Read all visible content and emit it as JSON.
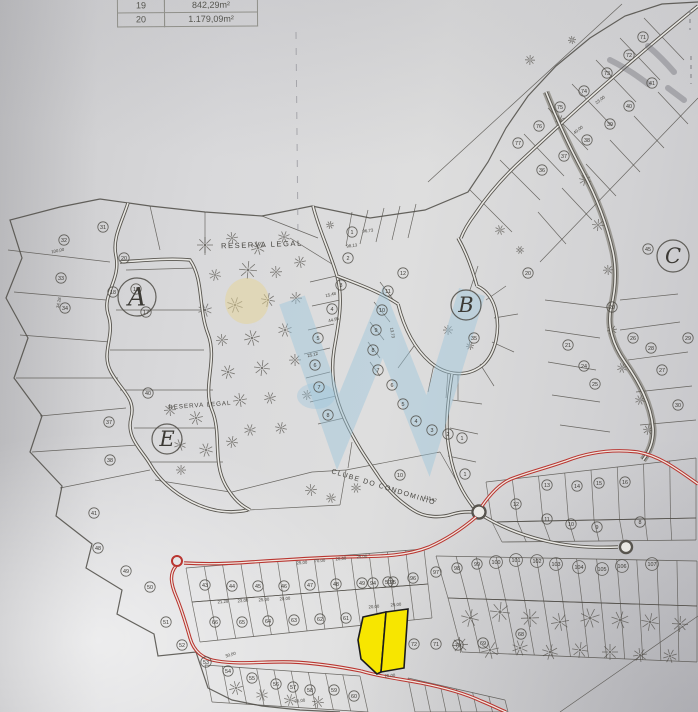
{
  "table": {
    "rows": [
      {
        "id": "19",
        "area": "842,29m²"
      },
      {
        "id": "20",
        "area": "1.179,09m²"
      }
    ]
  },
  "map": {
    "region_labels": [
      {
        "text": "RESERVA LEGAL",
        "x": 262,
        "y": 247,
        "rot": -2,
        "size": 7.5,
        "spacing": 1.6
      },
      {
        "text": "RESERVA LEGAL",
        "x": 200,
        "y": 407,
        "rot": -4,
        "size": 6.2,
        "spacing": 1
      },
      {
        "text": "CLUBE DO CONDOMINIO",
        "x": 383,
        "y": 489,
        "rot": 17,
        "size": 7,
        "spacing": 1.3
      }
    ],
    "sections": [
      {
        "letter": "A",
        "x": 137,
        "y": 297,
        "r": 19,
        "size": 25
      },
      {
        "letter": "B",
        "x": 466,
        "y": 305,
        "r": 15,
        "size": 21
      },
      {
        "letter": "C",
        "x": 673,
        "y": 256,
        "r": 16,
        "size": 21
      },
      {
        "letter": "E",
        "x": 167,
        "y": 439,
        "r": 15,
        "size": 21
      }
    ],
    "plot_numbers": [
      [
        31,
        103,
        227
      ],
      [
        32,
        64,
        240
      ],
      [
        33,
        61,
        278
      ],
      [
        34,
        65,
        308
      ],
      [
        20,
        124,
        258
      ],
      [
        19,
        136,
        289
      ],
      [
        18,
        113,
        292
      ],
      [
        17,
        146,
        312
      ],
      [
        37,
        109,
        422
      ],
      [
        40,
        148,
        393
      ],
      [
        38,
        110,
        460
      ],
      [
        41,
        94,
        513
      ],
      [
        48,
        98,
        548
      ],
      [
        49,
        126,
        571
      ],
      [
        50,
        150,
        587
      ],
      [
        51,
        166,
        622
      ],
      [
        52,
        182,
        645
      ],
      [
        3,
        341,
        285
      ],
      [
        4,
        332,
        309
      ],
      [
        5,
        318,
        338
      ],
      [
        6,
        315,
        365
      ],
      [
        7,
        319,
        387
      ],
      [
        8,
        328,
        415
      ],
      [
        1,
        352,
        232
      ],
      [
        2,
        348,
        258
      ],
      [
        12,
        403,
        273
      ],
      [
        11,
        388,
        291
      ],
      [
        10,
        382,
        310
      ],
      [
        9,
        376,
        330
      ],
      [
        8,
        373,
        350
      ],
      [
        7,
        378,
        370
      ],
      [
        6,
        392,
        385
      ],
      [
        5,
        403,
        404
      ],
      [
        4,
        416,
        421
      ],
      [
        3,
        432,
        430
      ],
      [
        2,
        448,
        434
      ],
      [
        1,
        462,
        438
      ],
      [
        20,
        528,
        273
      ],
      [
        35,
        474,
        338
      ],
      [
        71,
        643,
        37
      ],
      [
        72,
        629,
        55
      ],
      [
        73,
        607,
        73
      ],
      [
        74,
        584,
        91
      ],
      [
        75,
        560,
        107
      ],
      [
        76,
        539,
        126
      ],
      [
        77,
        518,
        143
      ],
      [
        38,
        587,
        140
      ],
      [
        37,
        564,
        156
      ],
      [
        36,
        542,
        170
      ],
      [
        39,
        610,
        124
      ],
      [
        40,
        629,
        106
      ],
      [
        41,
        652,
        83
      ],
      [
        45,
        648,
        249
      ],
      [
        20,
        612,
        307
      ],
      [
        21,
        568,
        345
      ],
      [
        24,
        584,
        366
      ],
      [
        25,
        595,
        384
      ],
      [
        26,
        633,
        338
      ],
      [
        28,
        651,
        348
      ],
      [
        27,
        662,
        370
      ],
      [
        29,
        688,
        338
      ],
      [
        30,
        678,
        405
      ],
      [
        43,
        205,
        585
      ],
      [
        44,
        232,
        586
      ],
      [
        45,
        258,
        586
      ],
      [
        46,
        284,
        586
      ],
      [
        47,
        310,
        585
      ],
      [
        48,
        336,
        584
      ],
      [
        49,
        362,
        583
      ],
      [
        50,
        388,
        582
      ],
      [
        66,
        215,
        622
      ],
      [
        65,
        242,
        622
      ],
      [
        64,
        268,
        621
      ],
      [
        63,
        294,
        620
      ],
      [
        62,
        320,
        619
      ],
      [
        61,
        346,
        618
      ],
      [
        72,
        414,
        644
      ],
      [
        71,
        436,
        644
      ],
      [
        70,
        458,
        645
      ],
      [
        69,
        483,
        643
      ],
      [
        68,
        521,
        634
      ],
      [
        94,
        373,
        583
      ],
      [
        95,
        393,
        582
      ],
      [
        96,
        413,
        578
      ],
      [
        97,
        436,
        572
      ],
      [
        98,
        457,
        568
      ],
      [
        99,
        477,
        564
      ],
      [
        100,
        496,
        562
      ],
      [
        101,
        516,
        560
      ],
      [
        102,
        537,
        561
      ],
      [
        103,
        556,
        564
      ],
      [
        104,
        579,
        567
      ],
      [
        105,
        602,
        569
      ],
      [
        106,
        622,
        566
      ],
      [
        107,
        652,
        564
      ],
      [
        13,
        547,
        485
      ],
      [
        14,
        577,
        486
      ],
      [
        15,
        599,
        483
      ],
      [
        16,
        625,
        482
      ],
      [
        12,
        516,
        504
      ],
      [
        11,
        547,
        519
      ],
      [
        10,
        571,
        524
      ],
      [
        9,
        597,
        527
      ],
      [
        8,
        640,
        522
      ],
      [
        10,
        400,
        475
      ],
      [
        1,
        465,
        474
      ],
      [
        53,
        206,
        662
      ],
      [
        54,
        228,
        671
      ],
      [
        55,
        252,
        678
      ],
      [
        56,
        276,
        684
      ],
      [
        57,
        293,
        687
      ],
      [
        58,
        310,
        690
      ],
      [
        59,
        334,
        690
      ],
      [
        60,
        354,
        696
      ]
    ],
    "measurements": [
      [
        "115,62",
        430,
        500,
        17
      ],
      [
        "100,00",
        58,
        252,
        -12
      ],
      [
        "34,28",
        60,
        303,
        -78
      ],
      [
        "21,28",
        223,
        603,
        -4
      ],
      [
        "23,00",
        243,
        602,
        -4
      ],
      [
        "25,00",
        264,
        601,
        -4
      ],
      [
        "20,00",
        285,
        600,
        -4
      ],
      [
        "25,00",
        302,
        564,
        -4
      ],
      [
        "70,00",
        320,
        562,
        -4
      ],
      [
        "20,00",
        341,
        560,
        -4
      ],
      [
        "25,00",
        362,
        558,
        -4
      ],
      [
        "15,48",
        331,
        296,
        -14
      ],
      [
        "44,95",
        334,
        321,
        -14
      ],
      [
        "25,12",
        313,
        356,
        -14
      ],
      [
        "13,73",
        391,
        333,
        80
      ],
      [
        "23,00",
        601,
        101,
        -38
      ],
      [
        "40,00",
        579,
        131,
        -38
      ],
      [
        "20,00",
        374,
        608,
        -4
      ],
      [
        "25,00",
        396,
        606,
        -4
      ],
      [
        "25,00",
        390,
        677,
        -4
      ],
      [
        "30,00",
        231,
        656,
        -18
      ],
      [
        "35,00",
        300,
        702,
        -6
      ],
      [
        "98,13",
        352,
        247,
        -8
      ],
      [
        "96,73",
        368,
        232,
        -6
      ]
    ],
    "colors": {
      "ink": "#4e4b45",
      "road_red": "#b93530",
      "highlight_yellow": "#f7e600",
      "watermark_blue": "#9cc6dc",
      "watermark_yellow": "#e6d493",
      "paper": "#e9e8e4"
    }
  }
}
